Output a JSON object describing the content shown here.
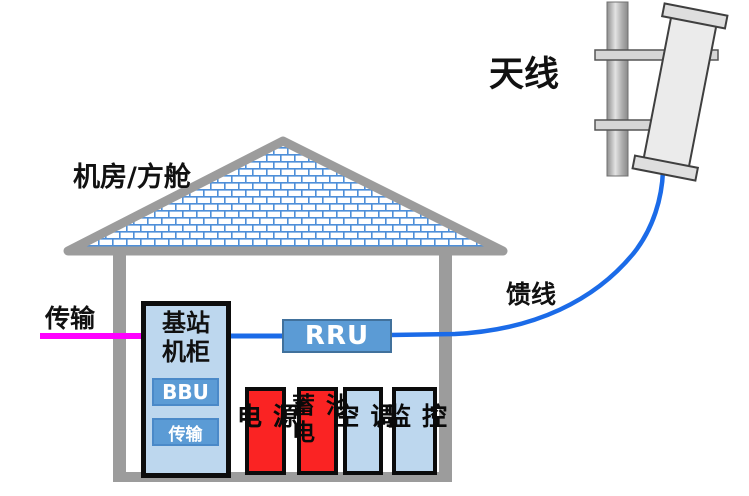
{
  "labels": {
    "antenna": "天线",
    "room": "机房/方舱",
    "transmission_in": "传输",
    "feeder": "馈线"
  },
  "cabinet": {
    "title": "基站\n机柜",
    "modules": [
      {
        "label": "BBU"
      },
      {
        "label": "传输"
      }
    ]
  },
  "rru": {
    "label": "RRU"
  },
  "equipment": [
    {
      "label": "电源",
      "type": "red"
    },
    {
      "label": "蓄电池",
      "type": "red"
    },
    {
      "label": "空调",
      "type": "blue"
    },
    {
      "label": "监控",
      "type": "blue"
    }
  ],
  "colors": {
    "structure_gray": "#9C9C9C",
    "brick_blue": "#4E8FD9",
    "light_blue_fill": "#BDD7EE",
    "mid_blue_fill": "#5B9BD5",
    "red_fill": "#FA2323",
    "magenta_line": "#FF00FF",
    "feeder_blue": "#1B6BE8",
    "border_black": "#0B0B0B"
  }
}
